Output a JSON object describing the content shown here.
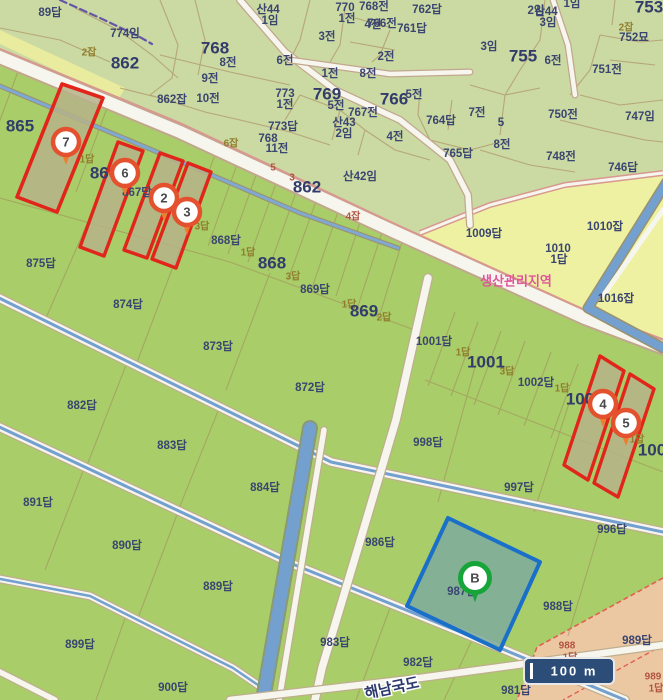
{
  "map_title": "cadastral-parcel-map",
  "colors": {
    "field_green": "#a9cd68",
    "village_sage": "#cbd9a2",
    "farm_yellow": "#edf1a1",
    "pink_strip": "#ecc8a2",
    "waterway_blue": "#74a0d0",
    "road_white": "#f7f6ee",
    "highlight_red": "#e1251b",
    "highlight_fill_olive": "#b6b288",
    "selected_blue": "#1a6fc9",
    "selected_fill_teal": "#80ad9b",
    "marker_ring_red": "#e4512e",
    "marker_tail_orange": "#ee7d2f",
    "marker_green": "#17a53a",
    "zone_label_pink": "#e0559b"
  },
  "zone_note": {
    "text": "생산관리지역"
  },
  "scale_bar": {
    "label": "100 m"
  },
  "road_name": {
    "text": "해남국도"
  },
  "markers": [
    {
      "n": "7",
      "x": 66,
      "y": 142,
      "c": "red"
    },
    {
      "n": "6",
      "x": 125,
      "y": 173,
      "c": "red"
    },
    {
      "n": "2",
      "x": 164,
      "y": 198,
      "c": "red"
    },
    {
      "n": "3",
      "x": 187,
      "y": 212,
      "c": "red"
    },
    {
      "n": "4",
      "x": 603,
      "y": 404,
      "c": "red"
    },
    {
      "n": "5",
      "x": 626,
      "y": 423,
      "c": "red"
    },
    {
      "n": "B",
      "x": 475,
      "y": 578,
      "c": "green"
    }
  ],
  "labels": [
    {
      "t": "89답",
      "x": 50,
      "y": 13,
      "k": "m"
    },
    {
      "t": "774임",
      "x": 125,
      "y": 34,
      "k": "m"
    },
    {
      "t": "2잡",
      "x": 89,
      "y": 53,
      "k": "o"
    },
    {
      "t": "862",
      "x": 125,
      "y": 64,
      "k": "b"
    },
    {
      "t": "산44",
      "x": 268,
      "y": 10,
      "k": "m"
    },
    {
      "t": "1임",
      "x": 270,
      "y": 21,
      "k": "m"
    },
    {
      "t": "3전",
      "x": 327,
      "y": 37,
      "k": "m"
    },
    {
      "t": "4전",
      "x": 373,
      "y": 25,
      "k": "m"
    },
    {
      "t": "산44",
      "x": 546,
      "y": 12,
      "k": "m"
    },
    {
      "t": "3임",
      "x": 548,
      "y": 23,
      "k": "m"
    },
    {
      "t": "768전",
      "x": 374,
      "y": 7,
      "k": "m"
    },
    {
      "t": "770",
      "x": 345,
      "y": 8,
      "k": "m"
    },
    {
      "t": "1전",
      "x": 347,
      "y": 19,
      "k": "m"
    },
    {
      "t": "766전",
      "x": 382,
      "y": 24,
      "k": "m"
    },
    {
      "t": "762답",
      "x": 427,
      "y": 10,
      "k": "m"
    },
    {
      "t": "761답",
      "x": 412,
      "y": 29,
      "k": "m"
    },
    {
      "t": "2임",
      "x": 536,
      "y": 11,
      "k": "m"
    },
    {
      "t": "1임",
      "x": 572,
      "y": 4,
      "k": "m"
    },
    {
      "t": "753",
      "x": 649,
      "y": 8,
      "k": "b"
    },
    {
      "t": "2잡",
      "x": 626,
      "y": 28,
      "k": "o"
    },
    {
      "t": "752묘",
      "x": 634,
      "y": 38,
      "k": "m"
    },
    {
      "t": "3임",
      "x": 489,
      "y": 47,
      "k": "m"
    },
    {
      "t": "755",
      "x": 523,
      "y": 57,
      "k": "b"
    },
    {
      "t": "6전",
      "x": 553,
      "y": 61,
      "k": "m"
    },
    {
      "t": "751전",
      "x": 607,
      "y": 70,
      "k": "m"
    },
    {
      "t": "747임",
      "x": 640,
      "y": 117,
      "k": "m"
    },
    {
      "t": "750전",
      "x": 563,
      "y": 115,
      "k": "m"
    },
    {
      "t": "748전",
      "x": 561,
      "y": 157,
      "k": "m"
    },
    {
      "t": "746답",
      "x": 623,
      "y": 168,
      "k": "m"
    },
    {
      "t": "768",
      "x": 215,
      "y": 49,
      "k": "b"
    },
    {
      "t": "8전",
      "x": 228,
      "y": 63,
      "k": "m"
    },
    {
      "t": "6전",
      "x": 285,
      "y": 61,
      "k": "m"
    },
    {
      "t": "9전",
      "x": 210,
      "y": 79,
      "k": "m"
    },
    {
      "t": "10전",
      "x": 208,
      "y": 99,
      "k": "m"
    },
    {
      "t": "1전",
      "x": 330,
      "y": 74,
      "k": "m"
    },
    {
      "t": "8전",
      "x": 368,
      "y": 74,
      "k": "m"
    },
    {
      "t": "769",
      "x": 327,
      "y": 95,
      "k": "b"
    },
    {
      "t": "5전",
      "x": 336,
      "y": 106,
      "k": "m"
    },
    {
      "t": "773",
      "x": 285,
      "y": 94,
      "k": "m"
    },
    {
      "t": "1전",
      "x": 285,
      "y": 105,
      "k": "m"
    },
    {
      "t": "766",
      "x": 394,
      "y": 100,
      "k": "b"
    },
    {
      "t": "2전",
      "x": 386,
      "y": 57,
      "k": "m"
    },
    {
      "t": "5전",
      "x": 414,
      "y": 95,
      "k": "m"
    },
    {
      "t": "767전",
      "x": 363,
      "y": 113,
      "k": "m"
    },
    {
      "t": "산43",
      "x": 344,
      "y": 123,
      "k": "m"
    },
    {
      "t": "2임",
      "x": 344,
      "y": 134,
      "k": "m"
    },
    {
      "t": "4전",
      "x": 395,
      "y": 137,
      "k": "m"
    },
    {
      "t": "764답",
      "x": 441,
      "y": 121,
      "k": "m"
    },
    {
      "t": "7전",
      "x": 477,
      "y": 113,
      "k": "m"
    },
    {
      "t": "5",
      "x": 501,
      "y": 123,
      "k": "m"
    },
    {
      "t": "8전",
      "x": 502,
      "y": 145,
      "k": "m"
    },
    {
      "t": "765답",
      "x": 458,
      "y": 154,
      "k": "m"
    },
    {
      "t": "773답",
      "x": 283,
      "y": 127,
      "k": "m"
    },
    {
      "t": "768",
      "x": 268,
      "y": 139,
      "k": "m"
    },
    {
      "t": "11전",
      "x": 277,
      "y": 149,
      "k": "m"
    },
    {
      "t": "6잡",
      "x": 231,
      "y": 144,
      "k": "o"
    },
    {
      "t": "862잡",
      "x": 172,
      "y": 100,
      "k": "m"
    },
    {
      "t": "산42임",
      "x": 360,
      "y": 177,
      "k": "m"
    },
    {
      "t": "862",
      "x": 307,
      "y": 188,
      "k": "b"
    },
    {
      "t": "5",
      "x": 273,
      "y": 168,
      "k": "r"
    },
    {
      "t": "3",
      "x": 292,
      "y": 178,
      "k": "r"
    },
    {
      "t": "4잡",
      "x": 353,
      "y": 217,
      "k": "r"
    },
    {
      "t": "865",
      "x": 20,
      "y": 127,
      "k": "b"
    },
    {
      "t": "1답",
      "x": 87,
      "y": 160,
      "k": "o"
    },
    {
      "t": "866",
      "x": 104,
      "y": 174,
      "k": "b"
    },
    {
      "t": "867답",
      "x": 137,
      "y": 193,
      "k": "m"
    },
    {
      "t": "3답",
      "x": 202,
      "y": 227,
      "k": "o"
    },
    {
      "t": "868답",
      "x": 226,
      "y": 241,
      "k": "m"
    },
    {
      "t": "1답",
      "x": 248,
      "y": 253,
      "k": "o"
    },
    {
      "t": "868",
      "x": 272,
      "y": 264,
      "k": "b"
    },
    {
      "t": "3답",
      "x": 293,
      "y": 277,
      "k": "o"
    },
    {
      "t": "869답",
      "x": 315,
      "y": 290,
      "k": "m"
    },
    {
      "t": "1답",
      "x": 349,
      "y": 305,
      "k": "o"
    },
    {
      "t": "869",
      "x": 364,
      "y": 312,
      "k": "b"
    },
    {
      "t": "2답",
      "x": 384,
      "y": 318,
      "k": "o"
    },
    {
      "t": "875답",
      "x": 41,
      "y": 264,
      "k": "m"
    },
    {
      "t": "874답",
      "x": 128,
      "y": 305,
      "k": "m"
    },
    {
      "t": "873답",
      "x": 218,
      "y": 347,
      "k": "m"
    },
    {
      "t": "872답",
      "x": 310,
      "y": 388,
      "k": "m"
    },
    {
      "t": "882답",
      "x": 82,
      "y": 406,
      "k": "m"
    },
    {
      "t": "883답",
      "x": 172,
      "y": 446,
      "k": "m"
    },
    {
      "t": "884답",
      "x": 265,
      "y": 488,
      "k": "m"
    },
    {
      "t": "891답",
      "x": 38,
      "y": 503,
      "k": "m"
    },
    {
      "t": "890답",
      "x": 127,
      "y": 546,
      "k": "m"
    },
    {
      "t": "889답",
      "x": 218,
      "y": 587,
      "k": "m"
    },
    {
      "t": "899답",
      "x": 80,
      "y": 645,
      "k": "m"
    },
    {
      "t": "900답",
      "x": 173,
      "y": 688,
      "k": "m"
    },
    {
      "t": "983답",
      "x": 335,
      "y": 643,
      "k": "m"
    },
    {
      "t": "982답",
      "x": 418,
      "y": 663,
      "k": "m"
    },
    {
      "t": "981답",
      "x": 516,
      "y": 691,
      "k": "m"
    },
    {
      "t": "986답",
      "x": 380,
      "y": 543,
      "k": "m"
    },
    {
      "t": "987답",
      "x": 462,
      "y": 592,
      "k": "m"
    },
    {
      "t": "988답",
      "x": 558,
      "y": 607,
      "k": "m"
    },
    {
      "t": "996답",
      "x": 612,
      "y": 530,
      "k": "m"
    },
    {
      "t": "997답",
      "x": 519,
      "y": 488,
      "k": "m"
    },
    {
      "t": "998답",
      "x": 428,
      "y": 443,
      "k": "m"
    },
    {
      "t": "1009답",
      "x": 484,
      "y": 234,
      "k": "m"
    },
    {
      "t": "1010",
      "x": 558,
      "y": 249,
      "k": "m"
    },
    {
      "t": "1답",
      "x": 559,
      "y": 260,
      "k": "m"
    },
    {
      "t": "1010잡",
      "x": 605,
      "y": 227,
      "k": "m"
    },
    {
      "t": "1016잡",
      "x": 616,
      "y": 299,
      "k": "m"
    },
    {
      "t": "1001답",
      "x": 434,
      "y": 342,
      "k": "m"
    },
    {
      "t": "1답",
      "x": 463,
      "y": 353,
      "k": "o"
    },
    {
      "t": "1001",
      "x": 486,
      "y": 363,
      "k": "b"
    },
    {
      "t": "3답",
      "x": 507,
      "y": 372,
      "k": "o"
    },
    {
      "t": "1002답",
      "x": 536,
      "y": 383,
      "k": "m"
    },
    {
      "t": "1답",
      "x": 562,
      "y": 389,
      "k": "o"
    },
    {
      "t": "100",
      "x": 580,
      "y": 400,
      "k": "b"
    },
    {
      "t": "1답",
      "x": 637,
      "y": 440,
      "k": "o"
    },
    {
      "t": "100",
      "x": 652,
      "y": 451,
      "k": "b"
    },
    {
      "t": "988",
      "x": 567,
      "y": 646,
      "k": "r"
    },
    {
      "t": "1답",
      "x": 570,
      "y": 658,
      "k": "r"
    },
    {
      "t": "989답",
      "x": 637,
      "y": 641,
      "k": "m"
    },
    {
      "t": "989",
      "x": 653,
      "y": 677,
      "k": "r"
    },
    {
      "t": "1답",
      "x": 656,
      "y": 689,
      "k": "r"
    }
  ]
}
